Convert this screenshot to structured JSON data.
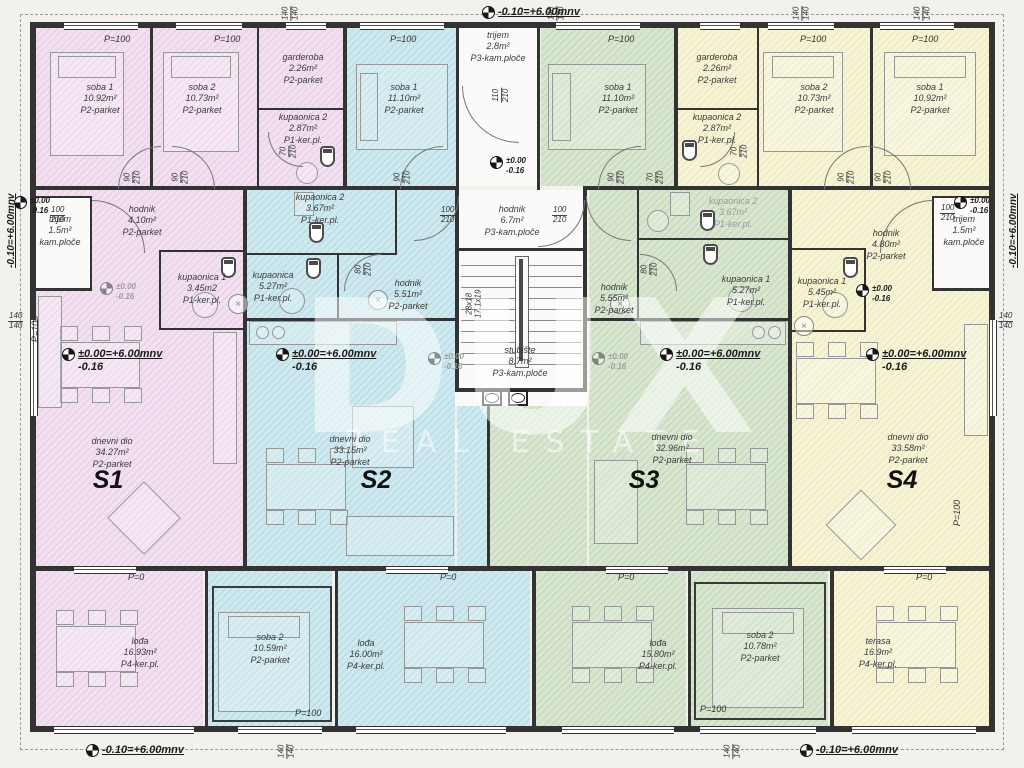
{
  "watermark": {
    "line1": "DUX",
    "line2": "REAL ESTATE"
  },
  "colors": {
    "s1": "#f2e0f1",
    "s2": "#cde8ee",
    "s3": "#d8e6d0",
    "s4": "#f6f4d5",
    "wall": "#333333"
  },
  "levels": {
    "top": "-0.10=+6.00mnv",
    "left": "-0.10=+6.00mnv",
    "right": "-0.10=+6.00mnv",
    "bottom_left": "-0.10=+6.00mnv",
    "bottom_right": "-0.10=+6.00mnv",
    "zero": "±0.00",
    "minus16": "-0.16",
    "combo": "±0.00=+6.00mnv"
  },
  "dims": {
    "d140": "140",
    "d210": "210",
    "d110": "110",
    "d100": "100",
    "d90": "90",
    "d80": "80",
    "d70": "70",
    "p100": "P=100",
    "p0": "P=0",
    "stair1": "28x18",
    "stair2": "17.1x19"
  },
  "common": {
    "trijem": {
      "name": "trijem",
      "area": "2.8m²",
      "floor": "P3-kam.ploče"
    },
    "hodnik": {
      "name": "hodnik",
      "area": "6.7m²",
      "floor": "P3-kam.ploče"
    },
    "stubiste": {
      "name": "stubište",
      "area": "8.7m²",
      "floor": "P3-kam.ploče"
    }
  },
  "s1": {
    "label": "S1",
    "soba1": {
      "name": "soba 1",
      "area": "10.92m²",
      "floor": "P2-parket"
    },
    "soba2": {
      "name": "soba 2",
      "area": "10.73m²",
      "floor": "P2-parket"
    },
    "garderoba": {
      "name": "garderoba",
      "area": "2.26m²",
      "floor": "P2-parket"
    },
    "kupaonica2": {
      "name": "kupaonica 2",
      "area": "2.87m²",
      "floor": "P1-ker.pl."
    },
    "hodnik": {
      "name": "hodnik",
      "area": "4.10m²",
      "floor": "P2-parket"
    },
    "kupaonica1": {
      "name": "kupaonica 1",
      "area": "3.45m2",
      "floor": "P1-ker.pl."
    },
    "trijem": {
      "name": "trijem",
      "area": "1.5m²",
      "floor": "kam.ploče"
    },
    "dnevni": {
      "name": "dnevni dio",
      "area": "34.27m²",
      "floor": "P2-parket"
    },
    "lodja": {
      "name": "lođa",
      "area": "16.93m²",
      "floor": "P4-ker.pl."
    }
  },
  "s2": {
    "label": "S2",
    "soba1": {
      "name": "soba 1",
      "area": "11.10m²",
      "floor": "P2-parket"
    },
    "kupaonica2": {
      "name": "kupaonica 2",
      "area": "3.67m²",
      "floor": "P1-ker.pl."
    },
    "kupaonica": {
      "name": "kupaonica",
      "area": "5.27m²",
      "floor": "P1-ker.pl."
    },
    "hodnik": {
      "name": "hodnik",
      "area": "5.51m²",
      "floor": "P2-parket"
    },
    "dnevni": {
      "name": "dnevni dio",
      "area": "33.15m²",
      "floor": "P2-parket"
    },
    "soba2": {
      "name": "soba 2",
      "area": "10.59m²",
      "floor": "P2-parket"
    },
    "lodja": {
      "name": "lođa",
      "area": "16.00m²",
      "floor": "P4-ker.pl."
    }
  },
  "s3": {
    "label": "S3",
    "soba1": {
      "name": "soba 1",
      "area": "11.10m²",
      "floor": "P2-parket"
    },
    "kupaonica2": {
      "name": "kupaonica 2",
      "area": "3.67m²",
      "floor": "P1-ker.pl."
    },
    "hodnik": {
      "name": "hodnik",
      "area": "5.55m²",
      "floor": "P2-parket"
    },
    "kupaonica1": {
      "name": "kupaonica 1",
      "area": "5.27m²",
      "floor": "P1-ker.pl."
    },
    "dnevni": {
      "name": "dnevni dio",
      "area": "32.96m²",
      "floor": "P2-parket"
    },
    "lodja": {
      "name": "lođa",
      "area": "15.80m²",
      "floor": "P4-ker.pl."
    },
    "soba2": {
      "name": "soba 2",
      "area": "10.78m²",
      "floor": "P2-parket"
    }
  },
  "s4": {
    "label": "S4",
    "garderoba": {
      "name": "garderoba",
      "area": "2.26m²",
      "floor": "P2-parket"
    },
    "kupaonica2": {
      "name": "kupaonica 2",
      "area": "2.87m²",
      "floor": "P1-ker.pl."
    },
    "soba2": {
      "name": "soba 2",
      "area": "10.73m²",
      "floor": "P2-parket"
    },
    "soba1": {
      "name": "soba 1",
      "area": "10.92m²",
      "floor": "P2-parket"
    },
    "hodnik": {
      "name": "hodnik",
      "area": "4.80m²",
      "floor": "P2-parket"
    },
    "kupaonica1": {
      "name": "kupaonica 1",
      "area": "5.45m²",
      "floor": "P1-ker.pl."
    },
    "trijem": {
      "name": "trijem",
      "area": "1.5m²",
      "floor": "kam.ploče"
    },
    "dnevni": {
      "name": "dnevni dio",
      "area": "33.58m²",
      "floor": "P2-parket"
    },
    "terasa": {
      "name": "terasa",
      "area": "16.9m²",
      "floor": "P4-ker.pl."
    }
  }
}
